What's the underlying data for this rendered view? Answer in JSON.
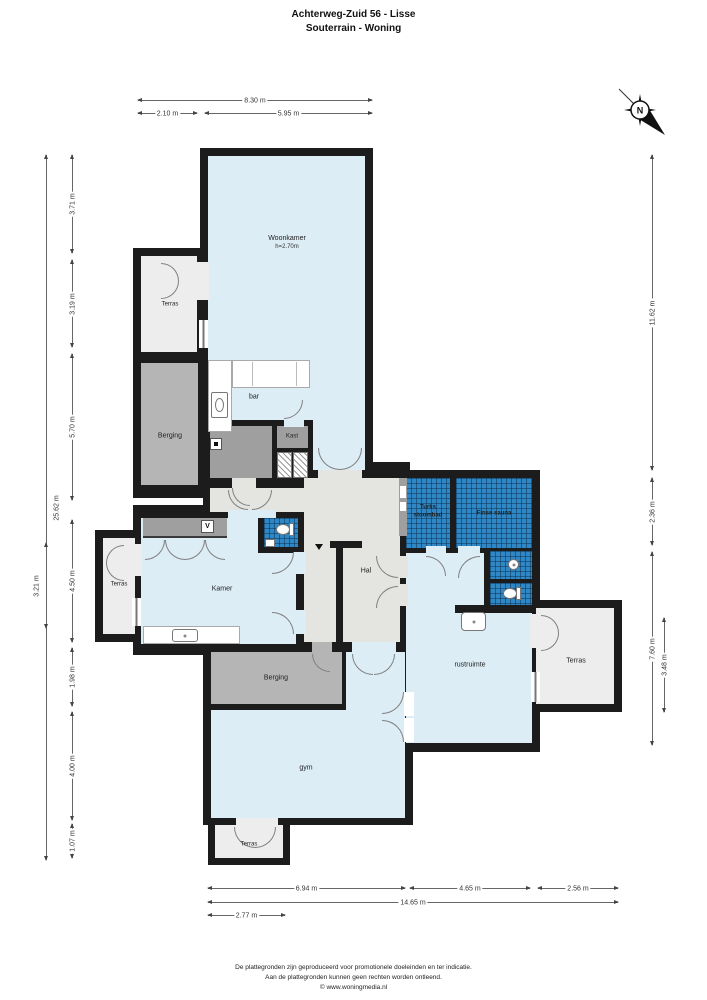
{
  "title": {
    "line1": "Achterweg-Zuid 56 - Lisse",
    "line2": "Souterrain - Woning"
  },
  "compass": {
    "north_label": "N"
  },
  "rooms": {
    "woonkamer": "Woonkamer",
    "woonkamer_height": "h=2.70m",
    "terras": "Terras",
    "berging": "Berging",
    "bar": "bar",
    "kast": "Kast",
    "hal": "Hal",
    "turks_stoombad": "Turks stoombad",
    "finse_sauna": "Finse sauna",
    "rustruimte": "rustruimte",
    "kamer": "Kamer",
    "gym": "gym",
    "v_marker": "V"
  },
  "colors": {
    "wall": "#1c1c1c",
    "room_blue": "#dcedf6",
    "tile_blue": "#2f88c5",
    "hall_gray": "#e4e4e0",
    "storage_gray": "#b5b5b5",
    "terrace_gray": "#ededed"
  },
  "dimensions": {
    "top": {
      "d830": "8.30 m",
      "d210": "2.10 m",
      "d595": "5.95 m"
    },
    "bottom": {
      "d694": "6.94 m",
      "d465": "4.65 m",
      "d256": "2.56 m",
      "d1465": "14.65 m",
      "d277": "2.77 m"
    },
    "left": {
      "d2562": "25.62 m",
      "d321": "3.21 m",
      "d371": "3.71 m",
      "d319": "3.19 m",
      "d570": "5.70 m",
      "d450": "4.50 m",
      "d198": "1.98 m",
      "d400": "4.00 m",
      "d107": "1.07 m"
    },
    "right": {
      "d1162": "11.62 m",
      "d236": "2.36 m",
      "d760": "7.60 m",
      "d348": "3.48 m"
    }
  },
  "footer": {
    "line1": "De plattegronden zijn geproduceerd voor promotionele doeleinden en ter indicatie.",
    "line2": "Aan de plattegronden kunnen geen rechten worden ontleend.",
    "line3": "© www.woningmedia.nl"
  }
}
